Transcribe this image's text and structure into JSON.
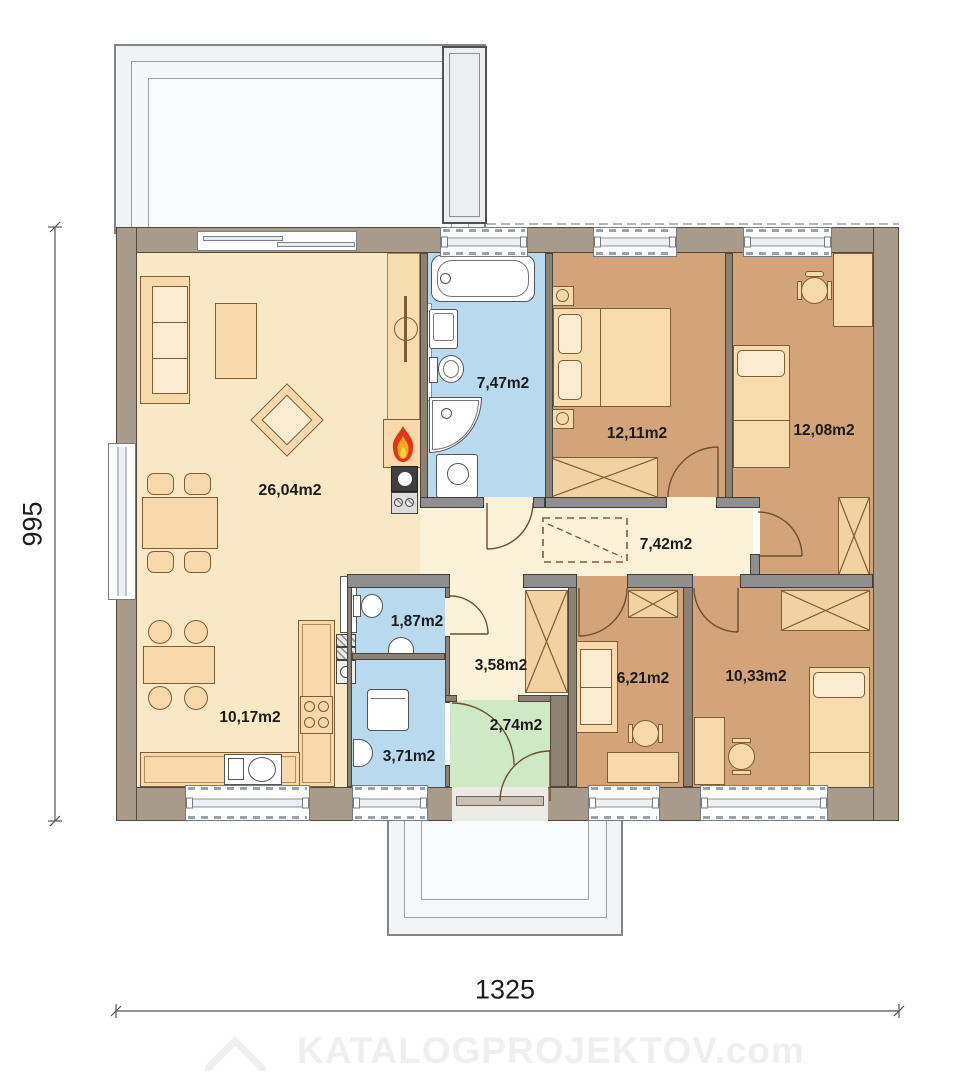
{
  "rooms": {
    "living": "26,04m2",
    "kitchen": "10,17m2",
    "bathroom": "7,47m2",
    "bedroom1": "12,11m2",
    "bedroom2": "12,08m2",
    "corridor": "7,42m2",
    "wc": "1,87m2",
    "hallway": "3,58m2",
    "vestibule": "2,74m2",
    "office": "6,21m2",
    "bedroom3": "10,33m2",
    "utility": "3,71m2"
  },
  "dimensions": {
    "width_label": "1325",
    "height_label": "995"
  },
  "watermark": {
    "text": "KATALOGPROJEKTOV.com"
  },
  "colors": {
    "exterior_wall": "#a99b8b",
    "interior_wall": "#8d8174",
    "door_jamb": "#8f8f8f",
    "floor_living": "#f8e8c6",
    "floor_corridor": "#fcf2da",
    "floor_bedroom": "#d3a479",
    "floor_bath": "#b9daee",
    "floor_vestibule": "#cfe8c5",
    "furniture": "#f7d9ab",
    "flame_red": "#e63312",
    "flame_orange": "#f7a81d"
  },
  "icons": {
    "fireplace": "flame-icon",
    "watermark_logo": "roof-icon"
  }
}
